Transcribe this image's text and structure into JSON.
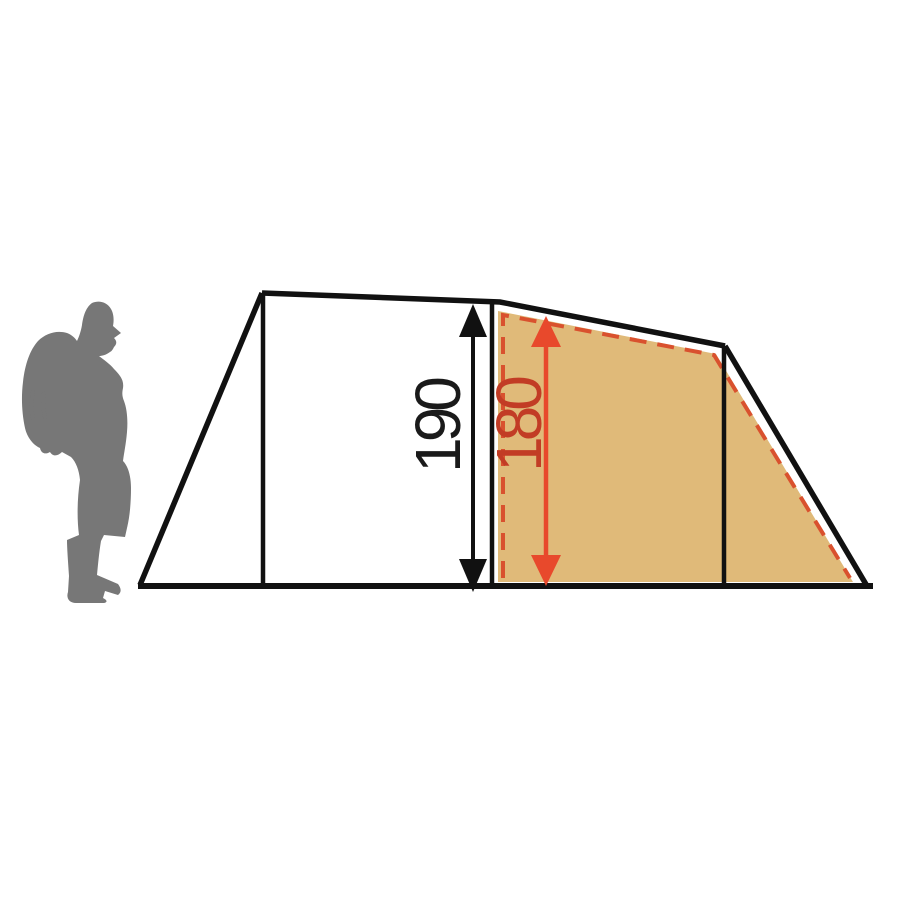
{
  "diagram": {
    "subject": "tent-side-profile-with-height-dimensions",
    "outer_height_label": "190",
    "inner_height_label": "180"
  },
  "colors": {
    "outline": "#111111",
    "inner-fill": "#e0ba79",
    "dash": "#d9512e",
    "arrow-red": "#e8492c",
    "text-red": "#c23c25",
    "text-black": "#1a1a1a",
    "silhouette": "#777777",
    "background": "#ffffff"
  }
}
